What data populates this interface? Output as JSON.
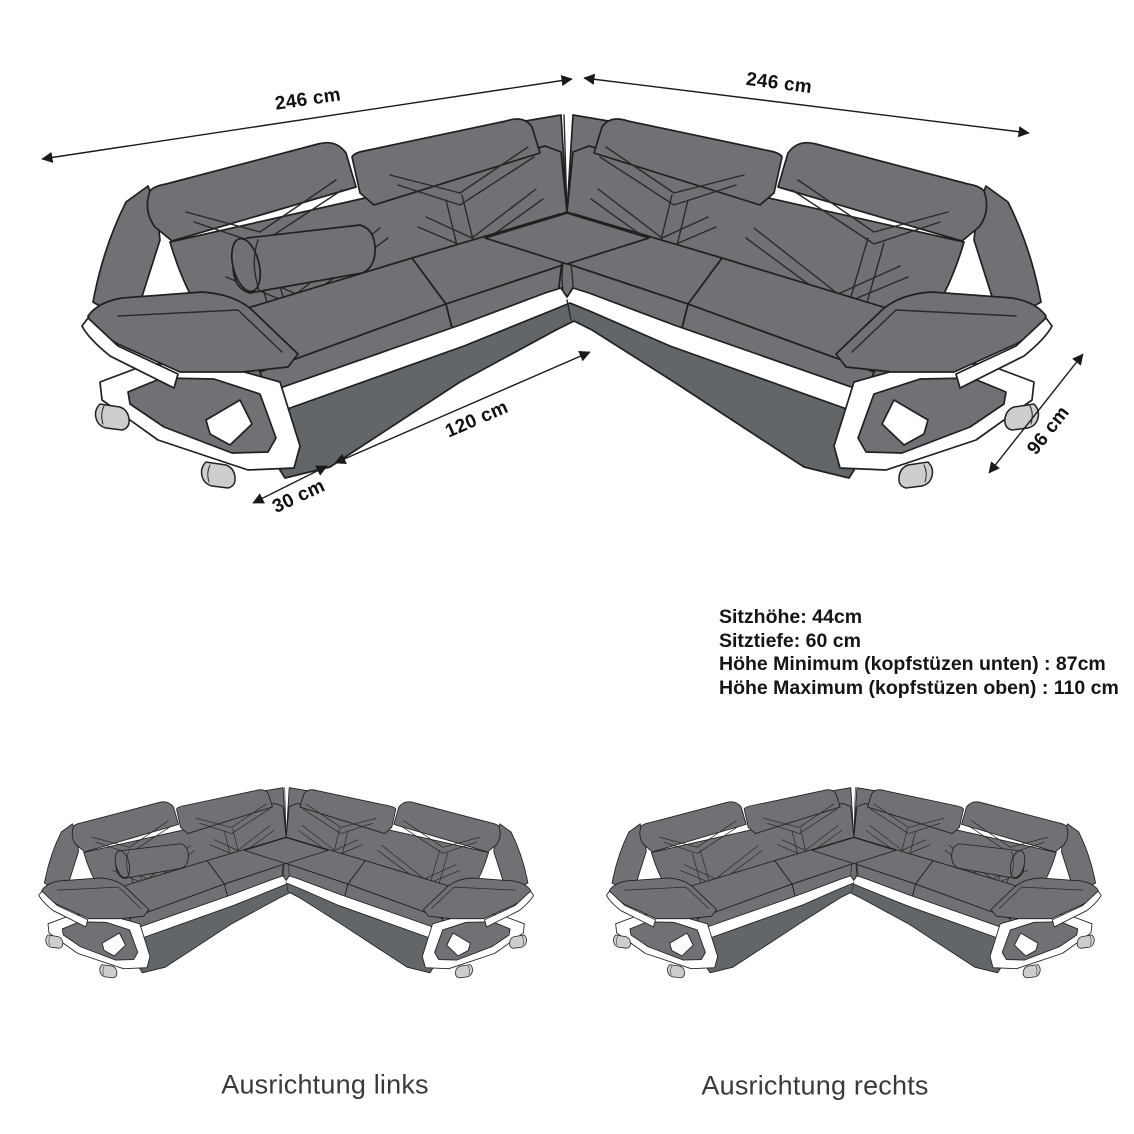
{
  "diagram": {
    "title": "corner sofa dimension diagram",
    "dimensions": {
      "back_left": "246 cm",
      "back_right": "246 cm",
      "front_long": "120 cm",
      "front_short": "30 cm",
      "side_right": "96 cm"
    },
    "specs": {
      "line1": "Sitzhöhe: 44cm",
      "line2": "Sitztiefe: 60 cm",
      "line3": "Höhe Minimum (kopfstüzen unten) : 87cm",
      "line4": "Höhe Maximum (kopfstüzen oben) : 110 cm"
    },
    "variants": {
      "left_label": "Ausrichtung links",
      "right_label": "Ausrichtung rechts"
    },
    "colors": {
      "sofa_body": "#6f7174",
      "sofa_base_band": "#636669",
      "sofa_outline": "#202020",
      "accent_stripe": "#ffffff",
      "feet": "#cdcdcd",
      "dimension_line": "#1a1a1a",
      "spec_text": "#151515",
      "caption_text": "#3a3a3a",
      "background": "#ffffff"
    }
  }
}
